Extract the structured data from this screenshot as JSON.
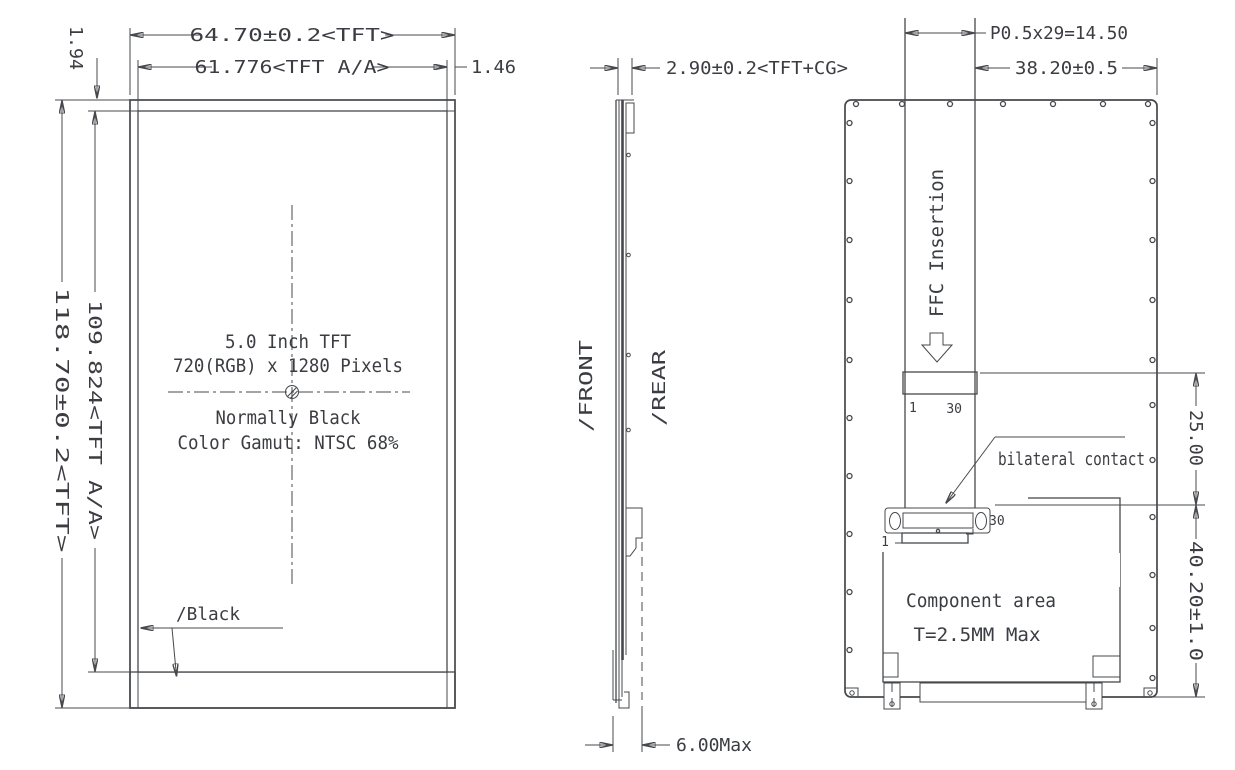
{
  "drawing": {
    "front": {
      "dim_width_tft": "64.70±0.2<TFT>",
      "dim_width_aa": "61.776<TFT A/A>",
      "dim_right_border": "1.46",
      "dim_top_border": "1.94",
      "dim_height_tft": "118.70±0.2<TFT>",
      "dim_height_aa": "109.824<TFT A/A>",
      "note_line1": "5.0 Inch TFT",
      "note_line2": "720(RGB) x 1280 Pixels",
      "note_line3": "Normally Black",
      "note_line4": "Color Gamut: NTSC 68%",
      "black_label": "/Black"
    },
    "side": {
      "dim_thickness": "2.90±0.2<TFT+CG>",
      "dim_max_thickness": "6.00Max",
      "label_front": "/FRONT",
      "label_rear": "/REAR"
    },
    "rear": {
      "dim_pitch": "P0.5x29=14.50",
      "dim_ffc_offset": "38.20±0.5",
      "dim_insertion": "25.00",
      "dim_component": "40.20±1.0",
      "ffc_label": "FFC Insertion",
      "pin_first_top": "1",
      "pin_last_top": "30",
      "pin_first_bottom": "1",
      "pin_last_bottom": "30",
      "bilateral_label": "bilateral contact",
      "component_area_label": "Component area",
      "component_thickness_label": "T=2.5MM Max"
    },
    "colors": {
      "line": "#46484c",
      "text": "#3b3d42",
      "background": "#ffffff",
      "band": "#23262b"
    }
  }
}
